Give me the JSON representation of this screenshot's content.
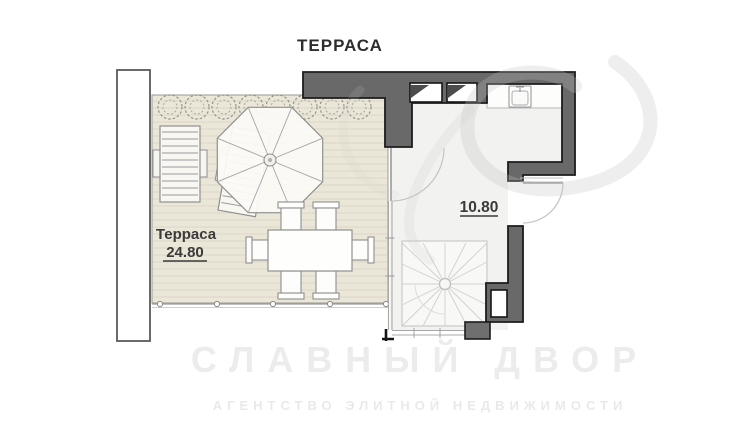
{
  "title": "ТЕРРАСА",
  "terrace": {
    "name": "Терраса",
    "area": "24.80"
  },
  "room": {
    "area": "10.80"
  },
  "watermark": {
    "line1": "СЛАВНЫЙ ДВОР",
    "line2": "АГЕНТСТВО ЭЛИТНОЙ НЕДВИЖИМОСТИ"
  },
  "colors": {
    "wall_fill": "#696969",
    "wall_outline": "#1c1c1c",
    "deck_fill": "#eae6d8",
    "deck_plank_line": "#dcd7c6",
    "room_floor": "#f2f2f0",
    "furniture_line": "#8f8f8f",
    "door_arc": "#c4c4c4",
    "label_text": "#3a3a3a"
  },
  "elements": {
    "legend": [
      "terrace-deck",
      "shrub-row",
      "sun-loungers",
      "parasol-umbrella",
      "dining-set",
      "building-walls",
      "window-niches",
      "kitchen-sink",
      "door-swings",
      "spiral-staircase",
      "railing"
    ]
  }
}
